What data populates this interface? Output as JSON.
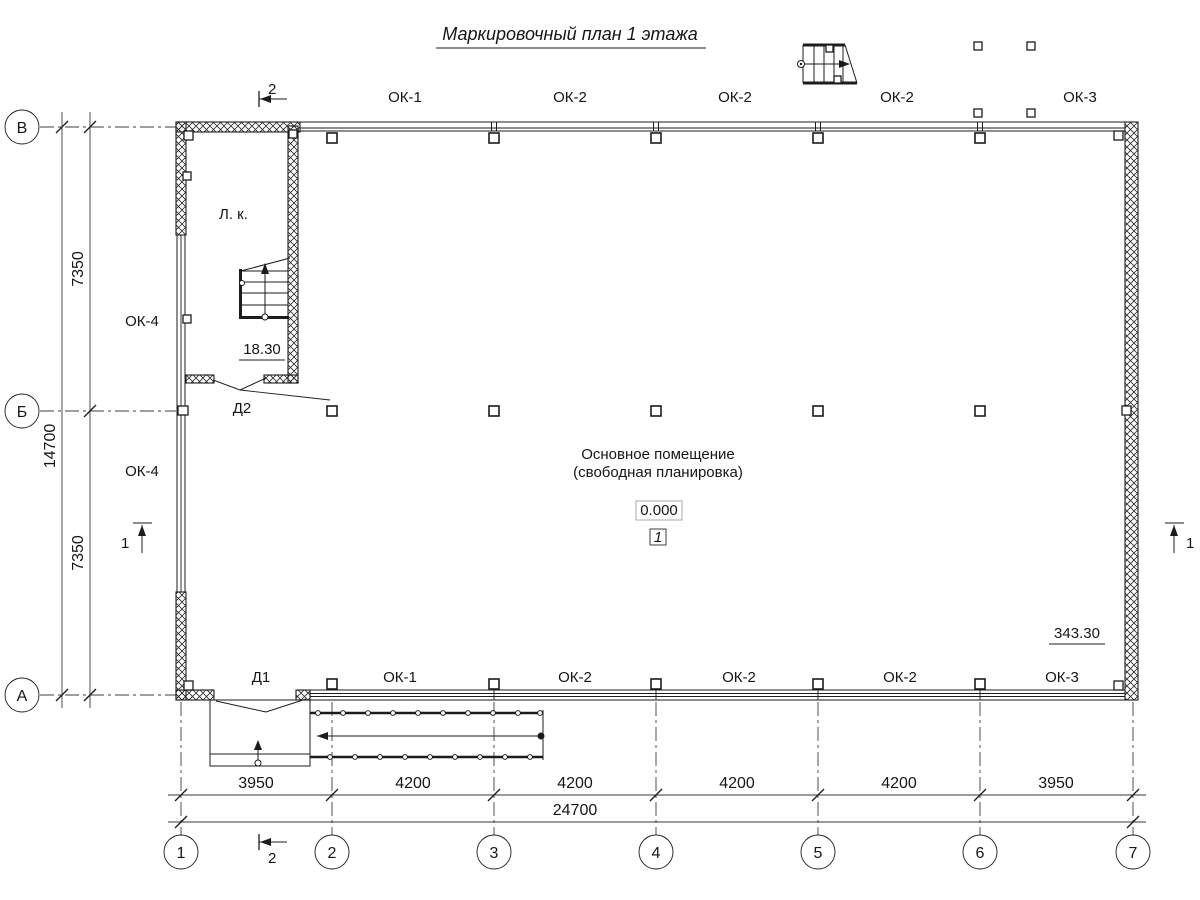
{
  "title": "Маркировочный план 1 этажа",
  "axes": {
    "rows": [
      "В",
      "Б",
      "А"
    ],
    "cols": [
      "1",
      "2",
      "3",
      "4",
      "5",
      "6",
      "7"
    ]
  },
  "dims": {
    "bottom": [
      "3950",
      "4200",
      "4200",
      "4200",
      "4200",
      "3950"
    ],
    "bottom_total": "24700",
    "left_upper": "7350",
    "left_lower": "7350",
    "left_total": "14700"
  },
  "windows": {
    "top": [
      "ОК-1",
      "ОК-2",
      "ОК-2",
      "ОК-2",
      "ОК-3"
    ],
    "bottom": [
      "ОК-1",
      "ОК-2",
      "ОК-2",
      "ОК-2",
      "ОК-3"
    ],
    "left_upper": "ОК-4",
    "left_lower": "ОК-4"
  },
  "doors": {
    "d1": "Д1",
    "d2": "Д2"
  },
  "room": {
    "name_line1": "Основное помещение",
    "name_line2": "(свободная планировка)",
    "number": "1",
    "level": "0.000"
  },
  "stair": {
    "label": "Л. к.",
    "elevation": "18.30"
  },
  "marks": {
    "elevation_right": "343.30",
    "section_1": "1",
    "section_2": "2"
  },
  "colors": {
    "line": "#1c1c1c",
    "background": "#ffffff"
  }
}
